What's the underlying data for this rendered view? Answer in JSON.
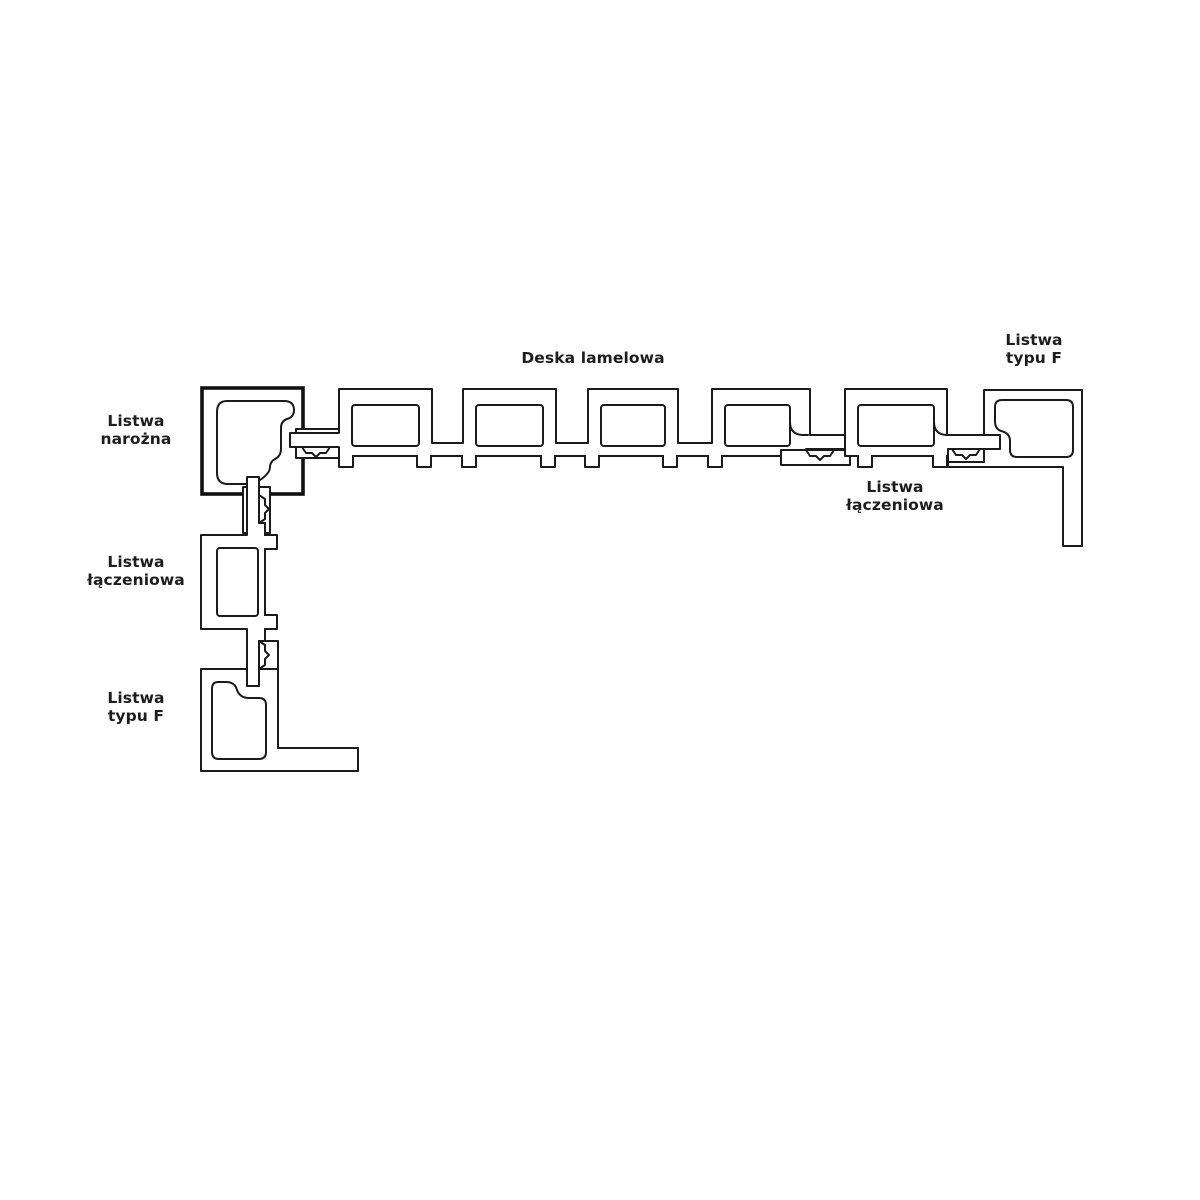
{
  "canvas": {
    "width": 1200,
    "height": 1200,
    "background": "#ffffff"
  },
  "colors": {
    "line": "#1b1b1b",
    "corner_outline": "#111111",
    "text": "#1d1d1d"
  },
  "labels": {
    "deska_lamelowa": {
      "line1": "Deska lamelowa"
    },
    "listwa_typu_f_top": {
      "line1": "Listwa",
      "line2": "typu F"
    },
    "listwa_narozna": {
      "line1": "Listwa",
      "line2": "narożna"
    },
    "listwa_laczeniowa_right": {
      "line1": "Listwa",
      "line2": "łączeniowa"
    },
    "listwa_laczeniowa_left": {
      "line1": "Listwa",
      "line2": "łączeniowa"
    },
    "listwa_typu_f_bottom": {
      "line1": "Listwa",
      "line2": "typu F"
    }
  }
}
